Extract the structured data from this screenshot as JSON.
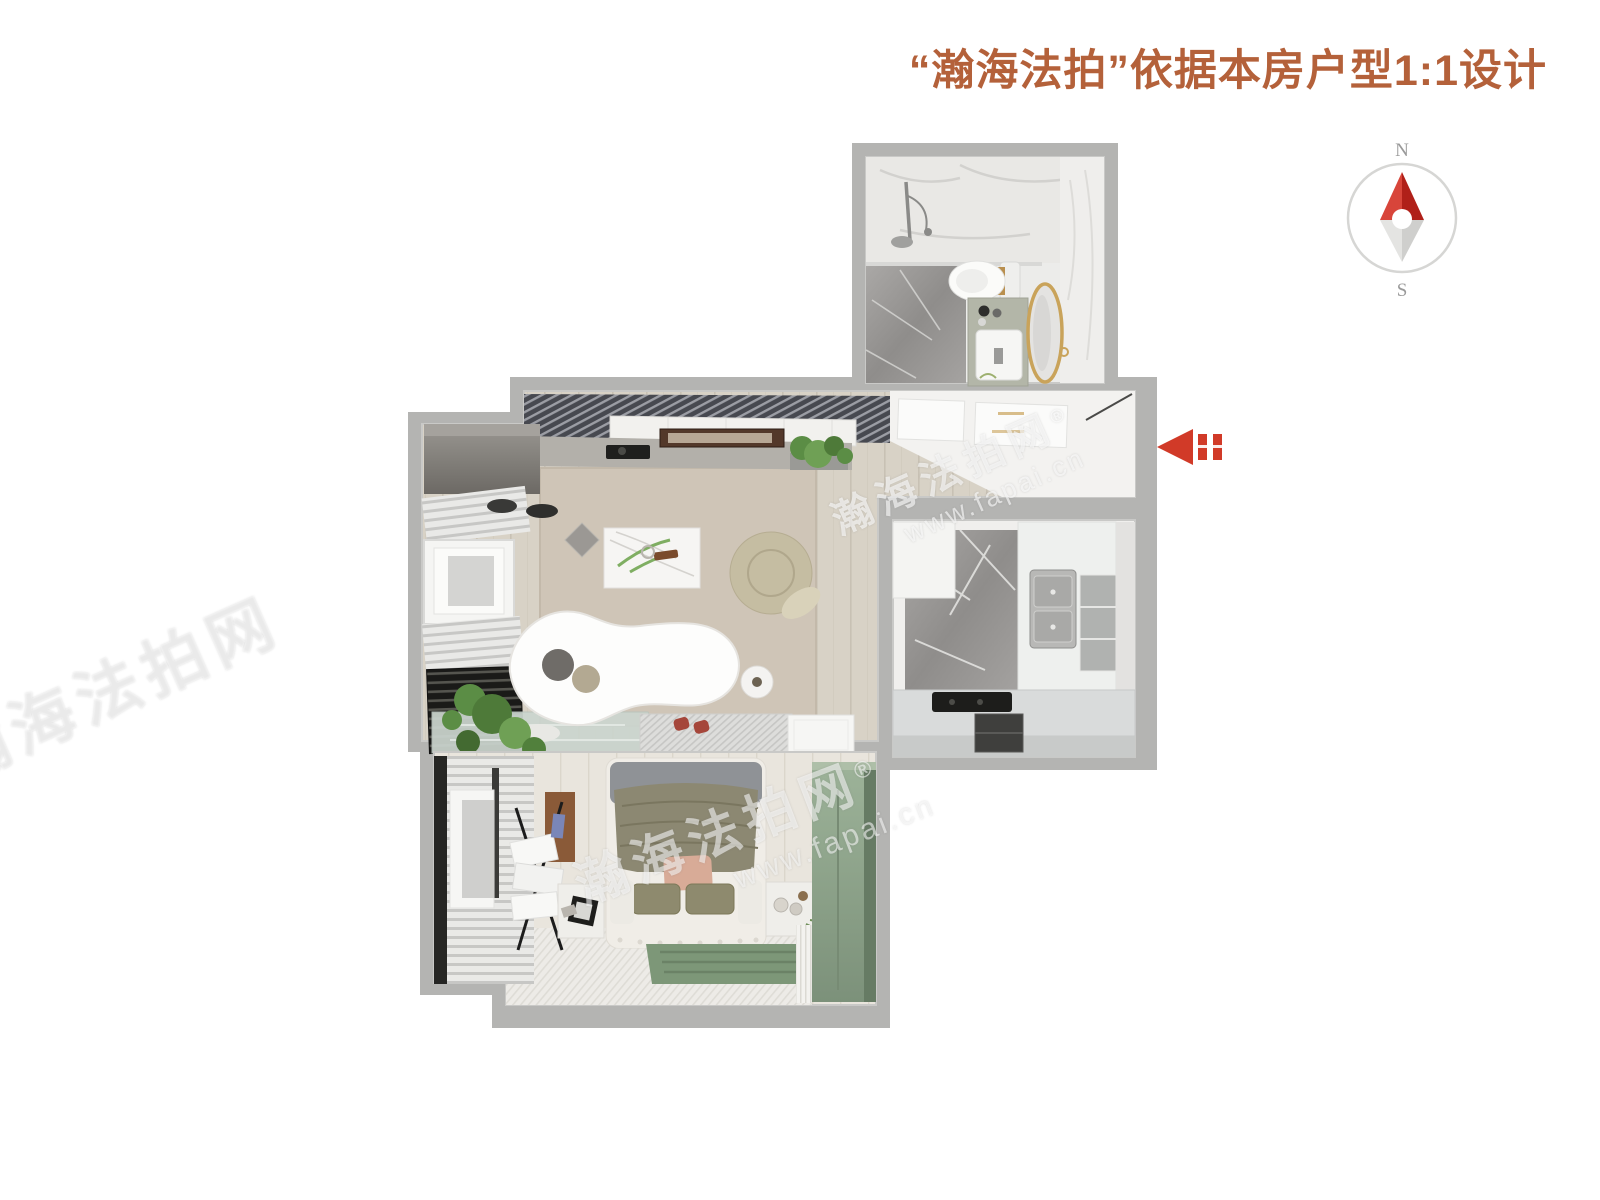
{
  "header": {
    "title": "“瀚海法拍”依据本房户型1:1设计",
    "title_color": "#b4613a"
  },
  "compass": {
    "north": "N",
    "south": "S"
  },
  "watermark": {
    "brand": "瀚海法拍网",
    "registered": "®",
    "url": "www.fapai.cn"
  },
  "colors": {
    "title": "#b4613a",
    "arrow_red": "#d13a28",
    "compass_red_light": "#d8453a",
    "compass_red_dark": "#b02019",
    "wall_gray": "#b4b4b2",
    "wood_floor": "#d8d2c6",
    "rug_beige": "#cfc5b7",
    "rug_green": "#7d9778",
    "wardrobe_green": "#8ba287",
    "duvet_olive": "#8c8872"
  },
  "rooms": {
    "bathroom": {
      "furniture": [
        "shower",
        "glass-divider",
        "toilet",
        "vanity-sink",
        "round-gold-mirror"
      ]
    },
    "living_room": {
      "furniture": [
        "louver-ceiling",
        "tv",
        "media-console",
        "plant",
        "corner-cabinet",
        "window",
        "blinds",
        "radiator",
        "coffee-table",
        "pouf",
        "sofa",
        "side-table",
        "indoor-pond",
        "entry-mat",
        "slippers",
        "tray"
      ]
    },
    "entry": {
      "furniture": [
        "ceiling-panels",
        "white-wall",
        "door"
      ]
    },
    "kitchen": {
      "furniture": [
        "upper-cabinet",
        "marble-floor",
        "double-sink",
        "shelf-niche",
        "counter",
        "cooktop",
        "open-shelf"
      ]
    },
    "bedroom": {
      "furniture": [
        "window",
        "magazine-rack",
        "double-bed",
        "pillows",
        "nightstand-left",
        "nightstand-right",
        "green-rug",
        "wardrobe",
        "sheer-curtain"
      ]
    }
  }
}
